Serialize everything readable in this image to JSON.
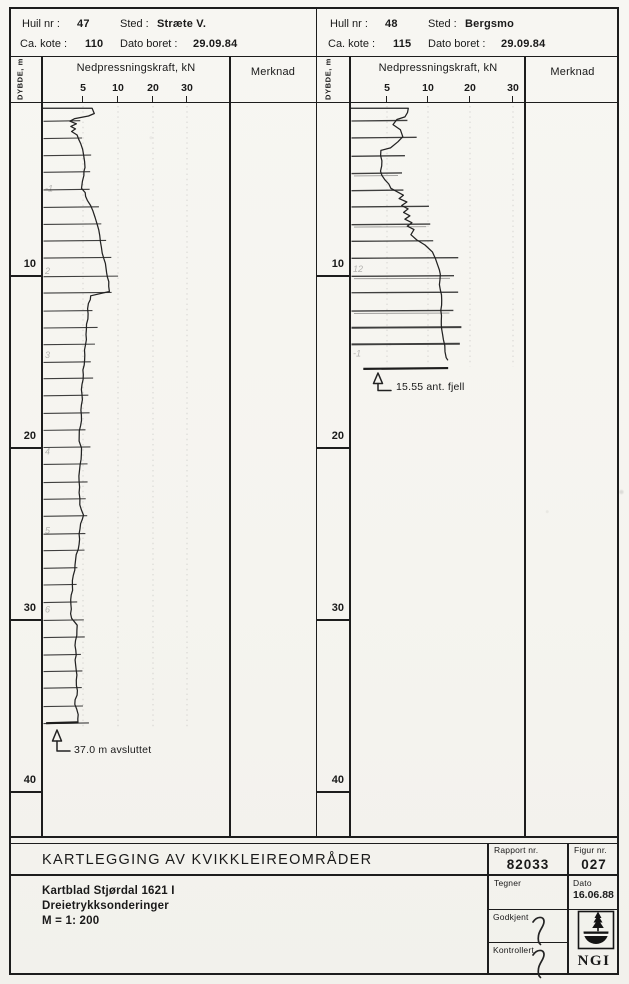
{
  "page": {
    "paper": "#f6f5f1",
    "ink": "#1d1d1d"
  },
  "panels": [
    {
      "info": {
        "hole_label": "Huil nr :",
        "hole_value": "47",
        "place_label": "Sted :",
        "place_value": "Stræte V.",
        "kote_label": "Ca. kote :",
        "kote_value": "110",
        "date_label": "Dato boret :",
        "date_value": "29.09.84"
      },
      "columns": {
        "depth_label": "DYBDE, m",
        "force_label": "Nedpressningskraft, kN",
        "remark_label": "Merknad"
      },
      "force_ticks": [
        "5",
        "10",
        "20",
        "30"
      ],
      "depth_ticks": [
        "10",
        "20",
        "30",
        "40"
      ],
      "annotation": {
        "text": "37.0 m avsluttet"
      },
      "pencil_marks": [
        {
          "depth": 4.9,
          "text": "-1"
        },
        {
          "depth": 9.7,
          "text": "2"
        },
        {
          "depth": 14.6,
          "text": "3"
        },
        {
          "depth": 20.2,
          "text": "4"
        },
        {
          "depth": 24.8,
          "text": "5"
        },
        {
          "depth": 29.4,
          "text": "6"
        }
      ]
    },
    {
      "info": {
        "hole_label": "Hull nr :",
        "hole_value": "48",
        "place_label": "Sted :",
        "place_value": "Bergsmo",
        "kote_label": "Ca. kote :",
        "kote_value": "115",
        "date_label": "Dato boret :",
        "date_value": "29.09.84"
      },
      "columns": {
        "depth_label": "DYBDE, m",
        "force_label": "Nedpressningskraft, kN",
        "remark_label": "Merknad"
      },
      "force_ticks": [
        "5",
        "10",
        "20",
        "30"
      ],
      "depth_ticks": [
        "10",
        "20",
        "30",
        "40"
      ],
      "annotation": {
        "text": "15.55 ant. fjell"
      },
      "pencil_marks": [
        {
          "depth": 9.6,
          "text": "12"
        },
        {
          "depth": 14.5,
          "text": "-1"
        }
      ]
    }
  ],
  "title_block": {
    "title": "KARTLEGGING AV KVIKKLEIREOMRÅDER",
    "line1": "Kartblad Stjørdal 1621 I",
    "line2": "Dreietrykksonderinger",
    "line3": "M = 1: 200",
    "report_label": "Rapport nr.",
    "report_value": "82033",
    "figure_label": "Figur nr.",
    "figure_value": "027",
    "drawn_label": "Tegner",
    "date_label": "Dato",
    "date_value": "16.06.88",
    "approved_label": "Godkjent",
    "checked_label": "Kontrollert",
    "logo_text": "NGI"
  },
  "chart_data": [
    {
      "type": "line",
      "title": "Dreietrykksondering Hull nr 47 - Stræte V.",
      "xlabel": "Nedpressningskraft, kN",
      "ylabel": "DYBDE, m",
      "x_ticks": [
        5,
        10,
        20,
        30
      ],
      "x_scale_note": "compressed scale: ticks 5,10,20,30 evenly spaced",
      "depth_ticks": [
        10,
        20,
        30,
        40
      ],
      "depth_range": [
        0,
        42.5
      ],
      "end_note": "37.0 m avsluttet",
      "end_line": {
        "depth": 36.0,
        "from": 0.5,
        "to": 4.4
      },
      "points": [
        [
          0.25,
          6.3
        ],
        [
          0.55,
          6.6
        ],
        [
          0.7,
          5.8
        ],
        [
          0.85,
          4.0
        ],
        [
          1.0,
          3.4
        ],
        [
          1.15,
          4.2
        ],
        [
          1.3,
          3.5
        ],
        [
          1.45,
          4.1
        ],
        [
          1.6,
          3.6
        ],
        [
          1.8,
          4.3
        ],
        [
          2.3,
          4.7
        ],
        [
          3.0,
          5.1
        ],
        [
          3.7,
          5.3
        ],
        [
          4.15,
          5.1
        ],
        [
          4.5,
          4.9
        ],
        [
          4.9,
          4.8
        ],
        [
          5.15,
          5.3
        ],
        [
          5.6,
          5.6
        ],
        [
          6.2,
          6.4
        ],
        [
          6.6,
          6.7
        ],
        [
          7.0,
          7.0
        ],
        [
          8.0,
          7.5
        ],
        [
          9.0,
          8.0
        ],
        [
          9.8,
          8.4
        ],
        [
          10.6,
          8.7
        ],
        [
          10.9,
          8.8
        ],
        [
          11.15,
          6.1
        ],
        [
          11.6,
          5.8
        ],
        [
          13.1,
          5.5
        ],
        [
          14.9,
          5.2
        ],
        [
          16.3,
          4.9
        ],
        [
          18.1,
          4.8
        ],
        [
          19.6,
          4.5
        ],
        [
          20.0,
          4.8
        ],
        [
          21.3,
          4.6
        ],
        [
          22.6,
          4.5
        ],
        [
          23.3,
          4.6
        ],
        [
          23.9,
          5.1
        ],
        [
          24.4,
          4.7
        ],
        [
          25.6,
          4.5
        ],
        [
          26.8,
          4.0
        ],
        [
          28.0,
          3.7
        ],
        [
          29.1,
          3.5
        ],
        [
          29.9,
          3.6
        ],
        [
          30.3,
          4.3
        ],
        [
          31.2,
          4.1
        ],
        [
          32.6,
          4.1
        ],
        [
          34.1,
          4.3
        ],
        [
          34.9,
          4.0
        ],
        [
          35.5,
          4.4
        ],
        [
          36.0,
          4.4
        ]
      ]
    },
    {
      "type": "line",
      "title": "Dreietrykksondering Hull nr 48 - Bergsmo",
      "xlabel": "Nedpressningskraft, kN",
      "ylabel": "DYBDE, m",
      "x_ticks": [
        5,
        10,
        20,
        30
      ],
      "x_scale_note": "compressed scale: ticks 5,10,20,30 evenly spaced",
      "depth_ticks": [
        10,
        20,
        30,
        40
      ],
      "depth_range": [
        0,
        42.5
      ],
      "end_note": "15.55 ant. fjell",
      "end_line": {
        "depth": 15.4,
        "from": 1.8,
        "to": 14.8
      },
      "points": [
        [
          0.25,
          7.6
        ],
        [
          0.75,
          7.2
        ],
        [
          0.9,
          6.2
        ],
        [
          1.2,
          5.7
        ],
        [
          1.5,
          6.6
        ],
        [
          1.9,
          6.9
        ],
        [
          2.2,
          6.3
        ],
        [
          2.55,
          5.4
        ],
        [
          2.7,
          4.2
        ],
        [
          3.3,
          4.3
        ],
        [
          3.9,
          4.1
        ],
        [
          4.4,
          4.7
        ],
        [
          4.9,
          5.5
        ],
        [
          5.3,
          7.0
        ],
        [
          5.5,
          6.5
        ],
        [
          5.7,
          7.4
        ],
        [
          5.9,
          6.8
        ],
        [
          6.1,
          7.6
        ],
        [
          6.3,
          7.0
        ],
        [
          6.5,
          7.8
        ],
        [
          6.7,
          7.2
        ],
        [
          6.9,
          8.0
        ],
        [
          7.1,
          7.5
        ],
        [
          7.3,
          8.3
        ],
        [
          7.6,
          7.9
        ],
        [
          7.9,
          8.6
        ],
        [
          8.2,
          9.6
        ],
        [
          8.6,
          11.0
        ],
        [
          9.0,
          11.8
        ],
        [
          9.4,
          12.4
        ],
        [
          9.9,
          12.9
        ],
        [
          10.8,
          12.9
        ],
        [
          11.7,
          13.3
        ],
        [
          12.6,
          13.1
        ],
        [
          13.1,
          13.3
        ],
        [
          13.7,
          13.6
        ],
        [
          14.4,
          14.0
        ],
        [
          14.75,
          14.3
        ],
        [
          14.9,
          14.8
        ]
      ]
    }
  ]
}
